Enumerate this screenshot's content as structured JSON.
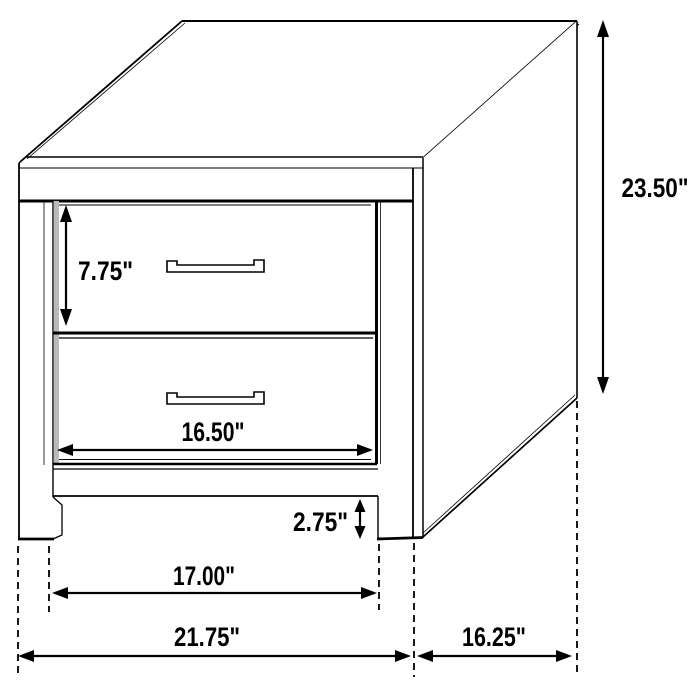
{
  "diagram": {
    "type": "furniture-dimension-diagram",
    "subject": "two-drawer nightstand",
    "dimensions": {
      "overall_height": "23.50\"",
      "overall_width": "21.75\"",
      "depth": "16.25\"",
      "drawer_height": "7.75\"",
      "opening_width": "16.50\"",
      "base_clearance": "2.75\"",
      "inner_width": "17.00\""
    },
    "colors": {
      "line": "#000000",
      "background": "#ffffff",
      "shading": "#b9b9b9"
    }
  }
}
